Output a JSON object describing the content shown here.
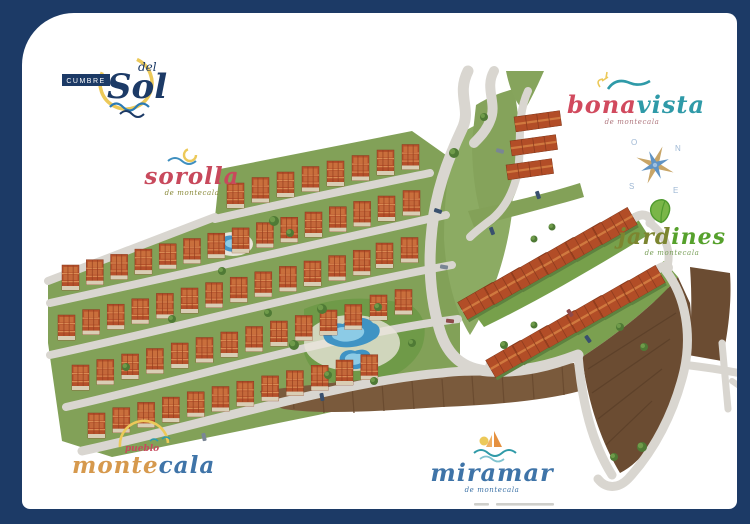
{
  "logo": {
    "badge": "CUMBRE",
    "del": "del",
    "name": "Sol"
  },
  "labels": {
    "sorolla": {
      "name": "sorolla",
      "tagline": "de montecala"
    },
    "bonavista": {
      "part1": "bona",
      "part2": "vista",
      "tagline": "de montecala"
    },
    "jardines": {
      "part1": "jard",
      "part2": "ines",
      "tagline": "de montecala"
    },
    "montecala": {
      "prefix": "pueblo",
      "part1": "monte",
      "part2": "cala"
    },
    "miramar": {
      "name": "miramar",
      "tagline": "de montecala"
    }
  },
  "compass": {
    "n": "N",
    "e": "E",
    "s": "S",
    "o": "O"
  },
  "colors": {
    "frame": "#1c3a66",
    "road": "#d9d6d0",
    "grass": "#82a158",
    "grass_bright": "#8cab63",
    "roof": "#b5502a",
    "pool": "#4695c5",
    "earth": "#7a5a3c",
    "earth_dark": "#6b4c32",
    "label_red": "#c8495c",
    "label_teal": "#2f9aa8",
    "label_green": "#56a12c",
    "label_olive": "#8a8a3a",
    "label_orange": "#d6994d",
    "label_blue": "#3f74a8",
    "navy": "#1c3a66"
  }
}
